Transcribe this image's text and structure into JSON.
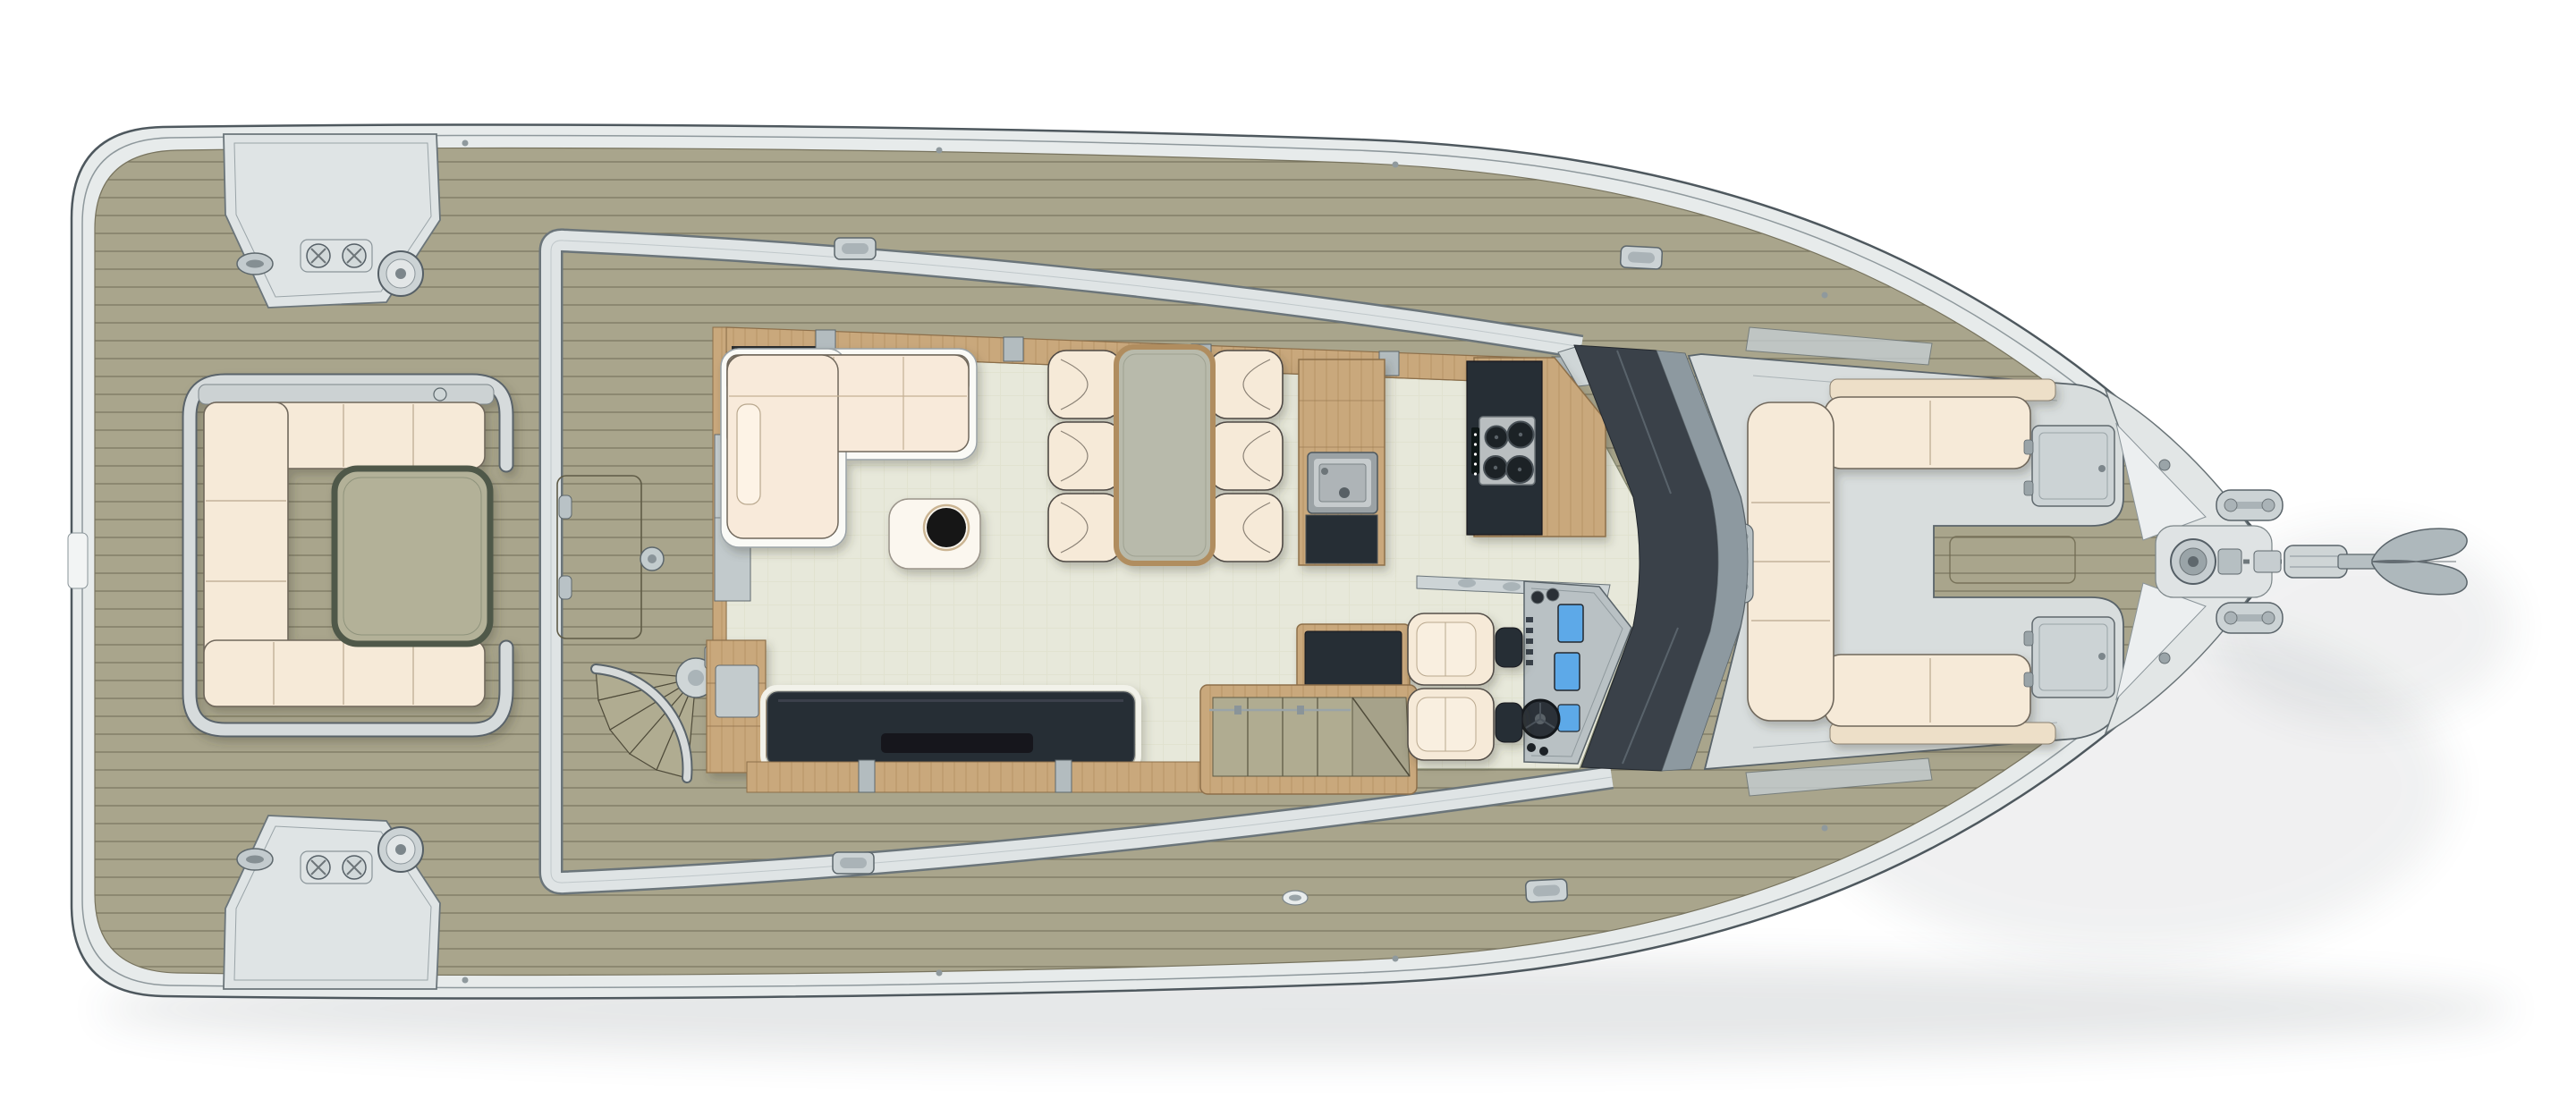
{
  "figure": {
    "type": "yacht-main-deck-floor-plan",
    "view": "top-down plan",
    "orientation": "bow-right, stern-left",
    "visible_text": "none"
  },
  "colors": {
    "bg": "#ffffff",
    "hull-fill": "#e7ebeb",
    "hull-stroke": "#4e585e",
    "rim-line": "#8e989c",
    "teak": "#a9a58c",
    "plank": "#6e6a55",
    "gray-band": "#dfe4e5",
    "band-edge": "#6b757a",
    "floor": "#e7e8da",
    "floor-line": "#dcdcc9",
    "wood": "#c9a87c",
    "wood-line": "#a5814f",
    "wood-edge": "#8d6f4a",
    "cream": "#f6ead8",
    "cream-edge": "#6f675b",
    "cream-shade": "#eddfc8",
    "white-trim": "#fafaf6",
    "navy": "#272d35",
    "navy-deep": "#14181d",
    "olive-table": "#b3b198",
    "olive-edge": "#4f5848",
    "dining-top": "#b8baab",
    "steel": "#b9bec0",
    "steel-edge": "#6d7579",
    "burner": "#1e2227",
    "glass-dark": "#3a4149",
    "glass-mid": "#8d99a0",
    "glass-light": "#c6cfd3",
    "shell": "#d8dddd",
    "shell-edge": "#5a646a",
    "screen-blue": "#5da9e8",
    "fitting": "#ccd3d5",
    "seat-frame": "#d6dbdc",
    "tread": "#b0ac91",
    "tread-edge": "#4f4b3a"
  },
  "plan": {
    "aft_deck": {
      "features": [
        "port and starboard stern mooring stations with winch, cross bollards and fairlead",
        "U-shaped lounge with cream cushions",
        "cocktail table",
        "deck hatch",
        "deck fill cap",
        "curved fan steps to salon door"
      ],
      "lounge_cushion_segments": 8
    },
    "salon": {
      "features": [
        "L-shaped sofa",
        "coffee table with round black bowl",
        "dining table",
        "dining chairs",
        "TV sideboard",
        "aft wood cabinet",
        "wet-bar cabinet",
        "companionway stairs down"
      ],
      "dining_chairs": 6
    },
    "galley": {
      "features": [
        "wood sink unit with stainless sink",
        "island counter with black top and cooktop"
      ],
      "cooktop_burners": 4
    },
    "helm": {
      "features": [
        "two helm seats with dark armrest pads",
        "instrument console",
        "steering wheel",
        "dashboard sill"
      ],
      "seats": 2,
      "displays": 3
    },
    "bow_cockpit": {
      "features": [
        "C-shaped lounge opening forward",
        "two storage hatch lids",
        "wind deflector glass panels",
        "oval vent strip",
        "deck hatch between benches"
      ]
    },
    "foredeck": {
      "features": [
        "teak deck",
        "anchor windlass",
        "chain run and stopper",
        "bow roller",
        "anchor",
        "two mooring cleats",
        "deck fittings"
      ],
      "cleats": 2
    },
    "windshield": {
      "shape": "wrap-around chevron, apex forward"
    }
  }
}
